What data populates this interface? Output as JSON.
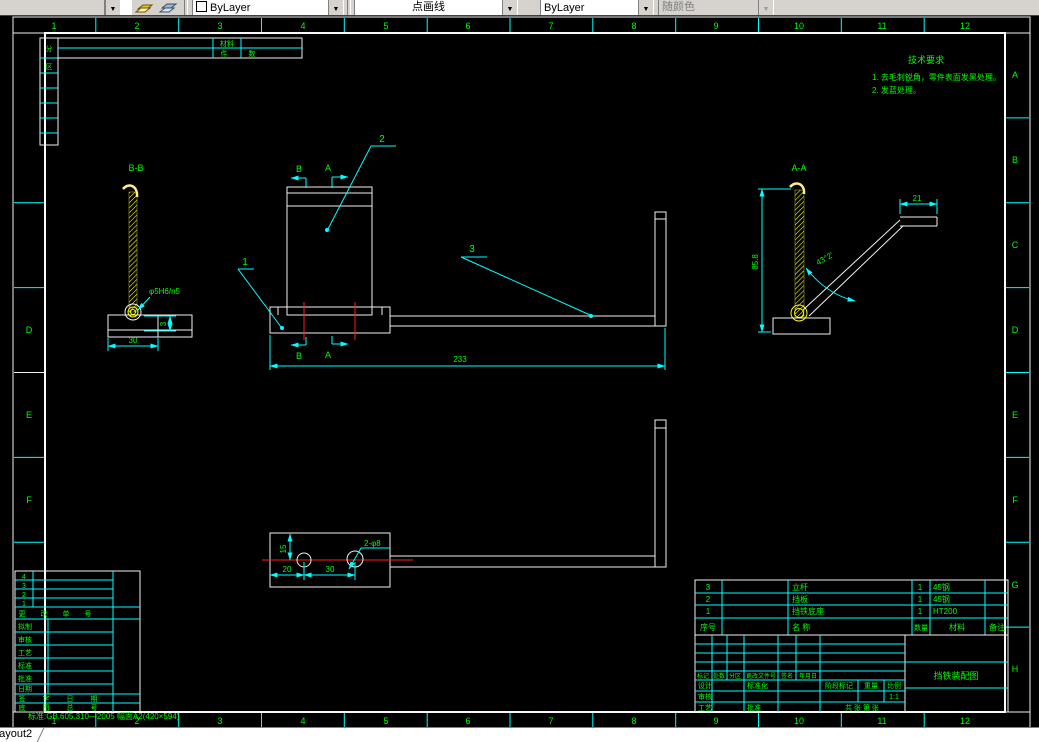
{
  "toolbar": {
    "layer_combo_value": "ByLayer",
    "linetype_combo_value": "点画线",
    "lineweight_combo_value": "ByLayer",
    "plotstyle_combo_value": "随颜色"
  },
  "statusbar": {
    "layout_tab": "Layout2"
  },
  "colors": {
    "frame": "#FFFFFF",
    "zone_label": "#00FF00",
    "grid": "#00FFFF",
    "dimension": "#00FFFF",
    "annotation": "#00FF00",
    "hatch": "#FFFF00",
    "centerline": "#FF2020",
    "canvas": "#000000"
  },
  "frame": {
    "cols": [
      "1",
      "2",
      "3",
      "4",
      "5",
      "6",
      "7",
      "8",
      "9",
      "10",
      "11",
      "12"
    ],
    "rows_right": [
      "A",
      "B",
      "C",
      "D",
      "E",
      "F",
      "G",
      "H"
    ],
    "rows_left": [
      "D",
      "E",
      "F"
    ]
  },
  "margin_tables": {
    "top_strip": {
      "r1c": "材料",
      "r2c1": "件",
      "r2c2": "数"
    },
    "left_strip": [
      "分",
      "区"
    ],
    "bottom_left": {
      "rev_rows": [
        "4",
        "3",
        "2",
        "1"
      ],
      "header_chars": [
        "更",
        "改",
        "单",
        "号"
      ],
      "labels": [
        "拟制",
        "审核",
        "工艺",
        "标准",
        "批准",
        "日期"
      ],
      "row7_chars": [
        "签",
        "字",
        "日",
        "期"
      ],
      "row8_chars": [
        "底",
        "图",
        "总",
        "号"
      ]
    },
    "footer_note": "标准:GB.605.310—2005  幅面A2(420×594)"
  },
  "tech_req": {
    "title": "技术要求",
    "item1": "1. 去毛刺锐角，零件表面发黑处理。",
    "item2": "2. 发蓝处理。"
  },
  "view_bb": {
    "label": "B-B",
    "hole_dim": "φ5H6/n5",
    "width_dim": "30",
    "height_dim": "3"
  },
  "view_main": {
    "balloon_1": "1",
    "balloon_2": "2",
    "balloon_3": "3",
    "section_a": "A",
    "section_b": "B",
    "length_dim": "233"
  },
  "view_aa": {
    "label": "A-A",
    "height_dim": "85.8",
    "top_dim": "21",
    "angle_dim": "43°2′"
  },
  "view_bottom": {
    "dim_15": "15",
    "dim_20": "20",
    "dim_30": "30",
    "holes_dim": "2-φ8"
  },
  "bom": {
    "header": {
      "no": "序号",
      "name": "名 称",
      "qty": "数量",
      "mat": "材料",
      "note": "备注"
    },
    "rows": [
      {
        "no": "3",
        "name": "立杆",
        "qty": "1",
        "mat": "45钢"
      },
      {
        "no": "2",
        "name": "挡板",
        "qty": "1",
        "mat": "45钢"
      },
      {
        "no": "1",
        "name": "挡铁底座",
        "qty": "1",
        "mat": "HT200"
      }
    ]
  },
  "title_block": {
    "drawing_title": "挡铁装配图",
    "mark": "标记",
    "count": "处数",
    "zone": "分区",
    "change_doc": "更改文件号",
    "sign": "签名",
    "date": "年月日",
    "design": "设计",
    "check": "审核",
    "process": "工艺",
    "approve": "批准",
    "standard": "标准化",
    "stage": "阶段标记",
    "weight": "重量",
    "scale": "比例",
    "scale_value": "1:1",
    "sheets": "共 张 第 张"
  }
}
